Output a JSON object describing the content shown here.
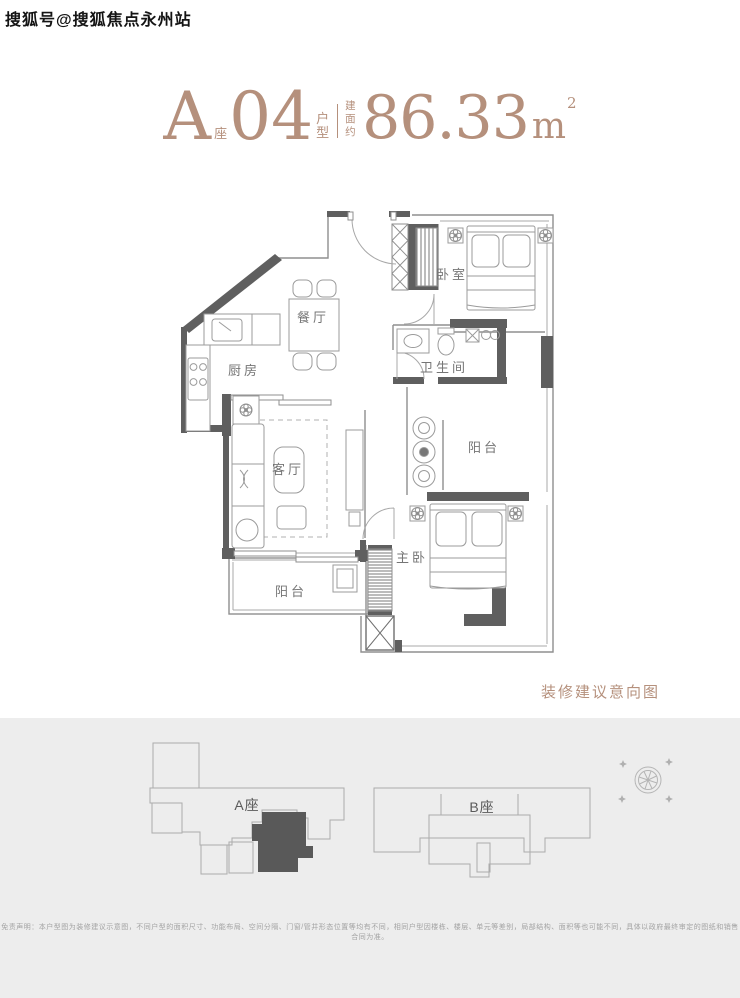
{
  "watermark": {
    "text": "搜狐号@搜狐焦点永州站"
  },
  "header": {
    "block_letter": "A",
    "block_char": "座",
    "unit_number": "04",
    "unit_type_label": "户型",
    "area_prefix": "建面约",
    "area_number": "86.33",
    "area_unit": "m",
    "area_exponent": "2"
  },
  "floorplan": {
    "caption": "装修建议意向图",
    "rooms": {
      "bedroom": "卧室",
      "dining": "餐厅",
      "kitchen": "厨房",
      "bathroom": "卫生间",
      "balcony_right": "阳台",
      "living": "客厅",
      "master": "主卧",
      "balcony_left": "阳台"
    }
  },
  "sitemap": {
    "block_a_label": "A座",
    "block_b_label": "B座",
    "compass_icon": "compass-icon",
    "highlighted_unit": "A-04"
  },
  "footer": {
    "disclaimer": "免责声明：本户型图为装修建议示意图，不同户型的面积尺寸、功能布局、空间分隔、门窗/管井形态位置等均有不同，相同户型因楼栋、楼层、单元等差别，局部结构、面积等也可能不同，具体以政府最终审定的图纸和销售合同为准。"
  },
  "colors": {
    "accent": "#b5907c",
    "wall": "#5f5f5f",
    "plan_line": "#9b9b9b",
    "panel_bg": "#ededed",
    "unit_highlight": "#595959"
  }
}
